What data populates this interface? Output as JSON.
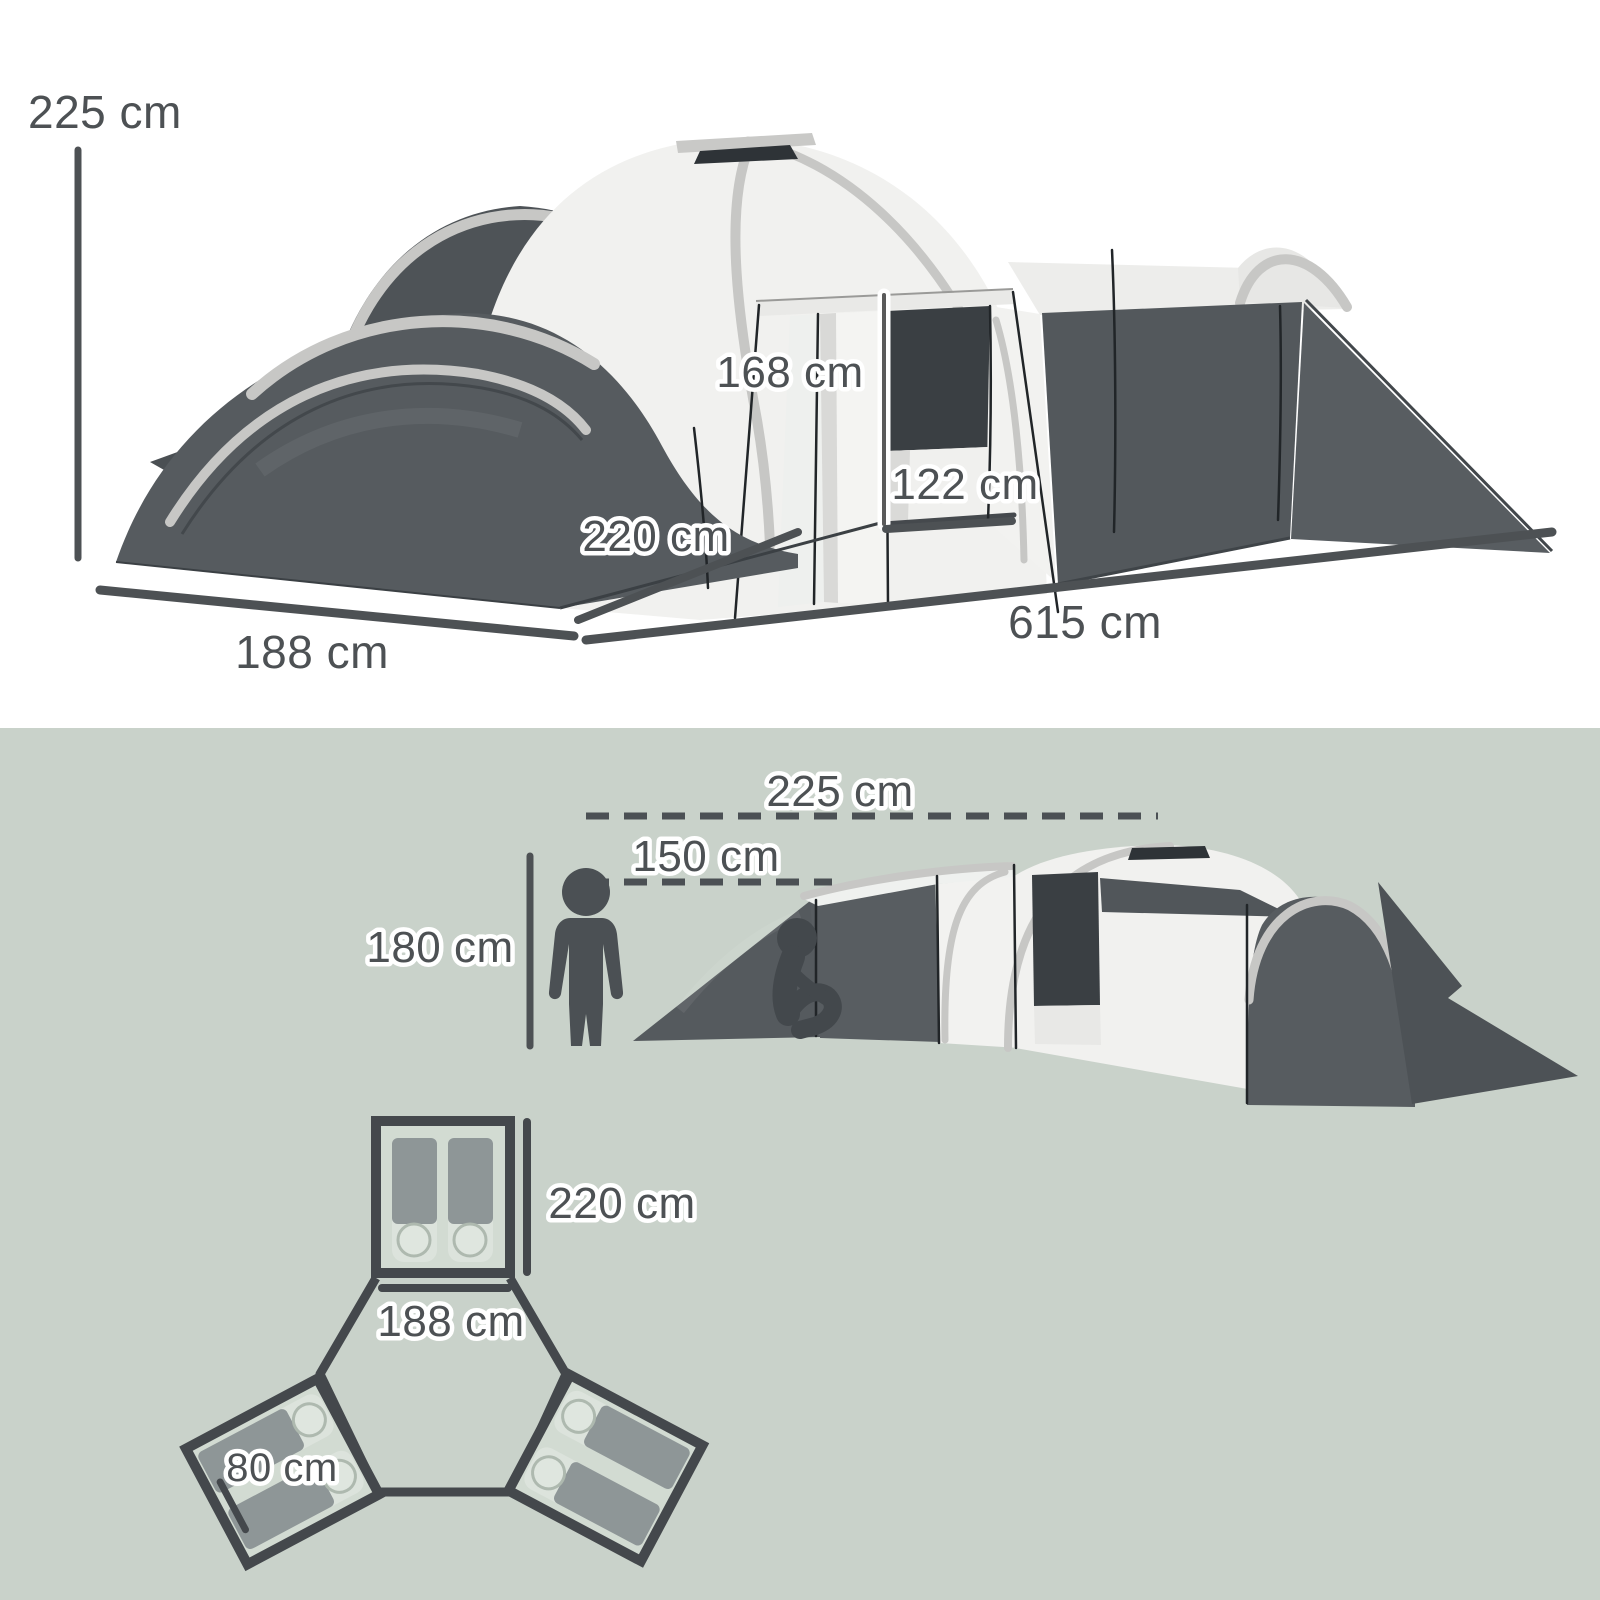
{
  "figure_title": "tent-dimension-diagram",
  "top_diagram": {
    "labels": {
      "total_height": "225 cm",
      "door_height": "168 cm",
      "door_width": "122 cm",
      "pod_depth": "220 cm",
      "front_width": "188 cm",
      "side_length": "615 cm"
    }
  },
  "bottom_diagram": {
    "side_view": {
      "peak_height": "225 cm",
      "side_wall_height": "150 cm",
      "person_height": "180 cm"
    },
    "floor_plan": {
      "pod_length": "220 cm",
      "pod_width": "188 cm",
      "sleeping_bag_width": "80 cm"
    }
  },
  "colors": {
    "background_top": "#ffffff",
    "background_bottom": "#c9d2ca",
    "fabric_dark": "#565b5f",
    "fabric_light": "#f1f1ef",
    "pole_trim": "#c7c7c5",
    "dimension": "#4d5154",
    "plan_stroke": "#44484c",
    "sleeping_bag": "#8e9697"
  }
}
